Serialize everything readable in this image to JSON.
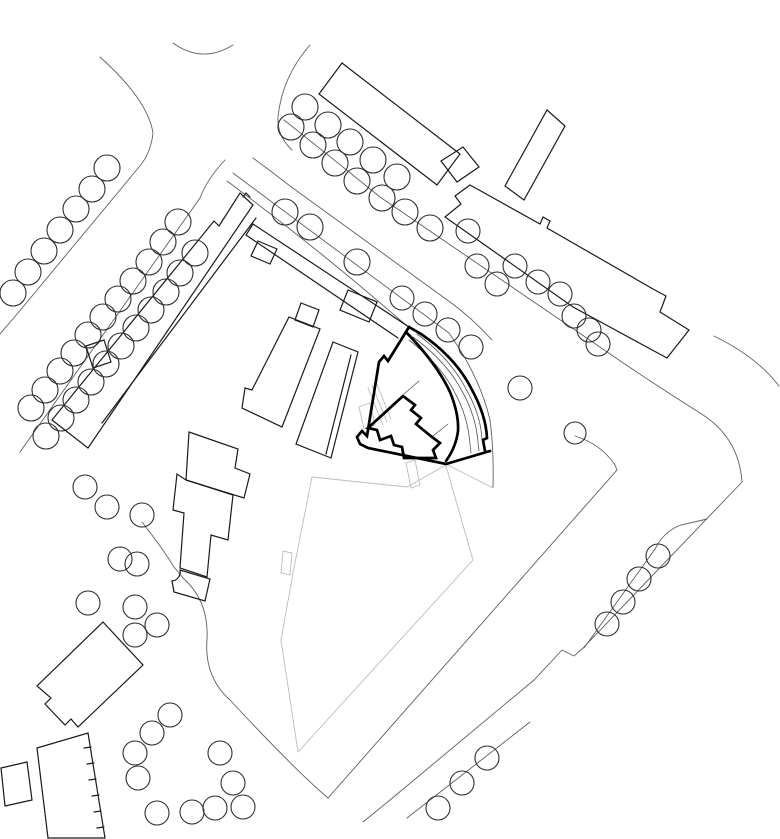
{
  "meta": {
    "type": "architectural-site-plan",
    "description": "black-and-white site plan with highlighted (bold) project building, tree circles, roads and neighbouring buildings",
    "canvas": {
      "width": 780,
      "height": 839
    },
    "colors": {
      "background": "#ffffff",
      "building_line": "#1a1a1a",
      "tree_line": "#2e2e2e",
      "road_line": "#5f5f5f",
      "light_gray_line": "#bdbdbd",
      "bold_highlight": "#000000"
    }
  },
  "styles": {
    "bld": {
      "stroke": "#1a1a1a",
      "width": 1.2
    },
    "tree": {
      "stroke": "#2e2e2e",
      "width": 1.1
    },
    "road": {
      "stroke": "#5f5f5f",
      "width": 0.9
    },
    "gray": {
      "stroke": "#bdbdbd",
      "width": 0.9
    },
    "bold": {
      "stroke": "#000000",
      "width": 2.7
    },
    "thin": {
      "stroke": "#555555",
      "width": 0.8
    }
  },
  "plan": {
    "gray_lines": [
      {
        "name": "plot-boundary-left",
        "d": "M312,477 L293,573 L281,640 L298,752"
      },
      {
        "name": "plot-boundary-right",
        "d": "M298,752 L473,560 L446,466"
      },
      {
        "name": "plot-boundary-top",
        "d": "M446,465 L407,487 L312,477"
      },
      {
        "name": "plot-connector",
        "d": "M446,464 L493,488"
      },
      {
        "name": "boundary-marker-rect",
        "d": "M283,551 L292,553 L290,575 L281,573 Z"
      },
      {
        "name": "entry-path-rect",
        "d": "M406,463 L415,460 L420,485 L411,488 Z"
      },
      {
        "name": "ramp-line-1",
        "d": "M368,388 L383,425"
      },
      {
        "name": "ramp-line-2",
        "d": "M372,385 L387,422"
      },
      {
        "name": "ramp-line-3",
        "d": "M376,382 L391,419"
      },
      {
        "name": "small-gray-rect",
        "d": "M359,407 L370,403 L375,425 L364,429 Z"
      }
    ],
    "roads": [
      {
        "name": "road-west-edge",
        "d": "M100,57 Q148,100 153,133 Q151,153 139,167 L18,313 L0,334"
      },
      {
        "name": "road-top-arc",
        "d": "M173,43 Q202,64 233,45"
      },
      {
        "name": "road-north-corner",
        "d": "M310,45 Q282,77 278,117 Q277,136 292,150"
      },
      {
        "name": "road-se-sw-edge",
        "d": "M253,158 Q272,172 290,186 L450,302 Q472,318 492,340"
      },
      {
        "name": "road-se-ne-edge",
        "d": "M284,120 Q332,158 380,197 L597,345 Q646,379 700,413 Q739,437 742,482"
      },
      {
        "name": "sidewalk-line-1",
        "d": "M233,173 Q340,253 449,333 Q480,377 490,420 Q494,450 493,487"
      },
      {
        "name": "sidewalk-line-2",
        "d": "M227,181 Q320,250 407,326"
      },
      {
        "name": "block-fence-west",
        "d": "M225,160 Q207,179 200,198 L20,452"
      },
      {
        "name": "path-around-houses",
        "d": "M142,522 Q163,549 174,567 Q179,573 183,578"
      },
      {
        "name": "road-south-edge",
        "d": "M575,436 Q601,444 615,465 L617,470 L328,798 Q294,769 230,700 Q204,677 207,639 Q209,601 183,578"
      },
      {
        "name": "road-southeast-edge",
        "d": "M742,482 L583,648 L574,656 L562,650 L534,680 L390,800 L363,822"
      },
      {
        "name": "road-northeast-arc",
        "d": "M714,336 Q757,357 779,386"
      },
      {
        "name": "road-se-corner-line",
        "d": "M407,818 L530,722"
      },
      {
        "name": "tree-enclosure",
        "d": "M584,648 L655,549 Q664,531 681,525 L707,519"
      }
    ],
    "buildings": [
      {
        "name": "long-building",
        "d": "M240,193 L253,205 L88,448 L52,420 L214,221 L219,226 Z"
      },
      {
        "name": "long-building-notch",
        "d": "M243,197 L246,193 L250,197"
      },
      {
        "name": "long-building-annex",
        "d": "M256,218 L102,423"
      },
      {
        "name": "terrace-strip-ne",
        "d": "M253,224 L409,327"
      },
      {
        "name": "terrace-strip-sw",
        "d": "M246,235 L398,338"
      },
      {
        "name": "terrace-strip-end",
        "d": "M253,224 L246,235"
      },
      {
        "name": "strip-bump-1",
        "d": "M258,241 L277,249 L270,264 L251,256 Z"
      },
      {
        "name": "strip-bump-2",
        "d": "M348,290 L377,302 L369,322 L340,310 Z"
      },
      {
        "name": "strip-connector",
        "d": "M301,303 L319,310 L313,327 L295,320 Z"
      },
      {
        "name": "planter",
        "d": "M86,346 L104,340 L111,362 L93,368 Z"
      },
      {
        "name": "center-slab-a",
        "d": "M289,317 L320,329 L282,427 L242,408 L245,388 L252,390 Z"
      },
      {
        "name": "center-slab-b",
        "d": "M333,342 L358,352 L331,458 L296,444 Z"
      },
      {
        "name": "center-slab-b-inner",
        "d": "M351,355 L326,454"
      },
      {
        "name": "ne-slab-1",
        "d": "M342,63 L319,94 L437,185 L460,154 Z"
      },
      {
        "name": "ne-link-square",
        "d": "M441,161 L463,147 L479,167 L457,182 Z"
      },
      {
        "name": "ne-building-2",
        "d": "M470,185 L540,224 L543,217 L550,221 L547,228 L653,289 L666,296 L660,312 L689,330 L667,358 L573,307 L445,217 L461,204 L455,196 Z"
      },
      {
        "name": "ne-building-2-wing",
        "d": "M547,110 L565,126 L524,200 L505,186 Z"
      },
      {
        "name": "house-a",
        "d": "M189,432 L238,449 L235,468 L250,474 L244,498 L186,480 Z"
      },
      {
        "name": "house-b",
        "d": "M186,480 L233,495 L228,540 L211,535 L207,577 L180,568 L184,513 L173,510 L177,474 Z"
      },
      {
        "name": "house-c",
        "d": "M180,570 L210,579 L205,601 L174,592 L172,581 A9,9 0 0 0 180,570 Z"
      },
      {
        "name": "house-d",
        "d": "M103,622 L143,665 L78,727 L71,719 L65,725 L45,704 L51,698 L37,686 Z"
      },
      {
        "name": "garage-building",
        "d": "M37,748 L88,733 L105,838 L48,838 Z"
      },
      {
        "name": "garage-ticks",
        "d": "M91,747 l-7,1 M94,763 l-7,1 M96,779 l-7,1 M99,795 l-7,1 M101,811 l-7,1 M104,827 l-7,1"
      },
      {
        "name": "sw-small-rect",
        "d": "M1,768 L27,762 L32,800 L5,806 Z"
      }
    ],
    "bold_building": {
      "label": "highlighted project building",
      "paths": [
        {
          "name": "site-boundary",
          "d": "M409,327 L388,361 L384,356 L379,362 L367,436 L362,431 L357,437 L360,444 L368,448 L446,464 L490,451"
        },
        {
          "name": "curved-band-outer",
          "d": "M409,327 L421,334 Q455,357 471,388 Q486,415 487,438 L483,440 L485,451"
        },
        {
          "name": "curved-band-inner",
          "d": "M406,332 Q437,364 450,392 Q459,414 458,431 Q456,447 446,461"
        },
        {
          "name": "inner-house",
          "d": "M403,396 L415,405 L411,410 L421,418 L416,424 L432,437 L440,443 L433,450 L436,458 L404,458 L402,447 L394,445 L391,436 L380,440 L377,430 L368,428 Z"
        }
      ],
      "thin_paths": [
        {
          "name": "balcony-curve-1",
          "d": "M413,337 Q446,361 462,391 Q476,416 478,442 L479,451"
        },
        {
          "name": "balcony-curve-2",
          "d": "M417,334 Q450,358 466,389 Q481,415 482,440"
        },
        {
          "name": "balcony-curve-3",
          "d": "M409,340 Q441,365 455,393 Q468,417 470,444 L471,453"
        },
        {
          "name": "link-line-1",
          "d": "M404,394 L419,381"
        },
        {
          "name": "link-line-2",
          "d": "M433,436 L448,424"
        }
      ]
    },
    "trees": {
      "default_radius": 13,
      "groups": [
        {
          "name": "upper-left-row",
          "r": 13,
          "centers": [
            [
              107,
              168
            ],
            [
              92,
              189
            ],
            [
              76,
              209
            ],
            [
              60,
              230
            ],
            [
              44,
              251
            ],
            [
              28,
              272
            ],
            [
              13,
              293
            ]
          ]
        },
        {
          "name": "west-row-1",
          "r": 13,
          "centers": [
            [
              178,
              222
            ],
            [
              163,
              242
            ],
            [
              149,
              262
            ],
            [
              133,
              281
            ],
            [
              118,
              299
            ],
            [
              103,
              317
            ],
            [
              88,
              335
            ],
            [
              74,
              353
            ],
            [
              60,
              371
            ],
            [
              45,
              390
            ],
            [
              31,
              408
            ]
          ]
        },
        {
          "name": "west-row-2",
          "r": 13,
          "centers": [
            [
              195,
              253
            ],
            [
              180,
              273
            ],
            [
              166,
              292
            ],
            [
              151,
              310
            ],
            [
              136,
              328
            ],
            [
              121,
              346
            ],
            [
              106,
              364
            ],
            [
              91,
              382
            ],
            [
              76,
              400
            ],
            [
              61,
              418
            ],
            [
              46,
              436
            ]
          ]
        },
        {
          "name": "west-lower-trio",
          "r": 12,
          "centers": [
            [
              85,
              487
            ],
            [
              107,
              507
            ],
            [
              142,
              515
            ]
          ]
        },
        {
          "name": "northeast-row-1",
          "r": 13,
          "centers": [
            [
              305,
              107
            ],
            [
              328,
              125
            ],
            [
              350,
              142
            ],
            [
              373,
              160
            ],
            [
              397,
              177
            ]
          ]
        },
        {
          "name": "northeast-row-2",
          "r": 13,
          "centers": [
            [
              291,
              127
            ],
            [
              313,
              145
            ],
            [
              335,
              163
            ],
            [
              357,
              181
            ],
            [
              382,
              198
            ],
            [
              405,
              212
            ],
            [
              430,
              228
            ]
          ]
        },
        {
          "name": "northeast-row-3",
          "r": 12,
          "centers": [
            [
              468,
              231
            ],
            [
              477,
              266
            ],
            [
              497,
              284
            ],
            [
              515,
              266
            ],
            [
              538,
              282
            ],
            [
              560,
              294
            ],
            [
              574,
              316
            ],
            [
              589,
              330
            ],
            [
              598,
              344
            ]
          ]
        },
        {
          "name": "corridor-trees",
          "r": 13,
          "centers": [
            [
              285,
              212
            ],
            [
              310,
              227
            ],
            [
              357,
              262
            ]
          ]
        },
        {
          "name": "project-row",
          "r": 12,
          "centers": [
            [
              402,
              298
            ],
            [
              425,
              314
            ],
            [
              448,
              330
            ],
            [
              471,
              347
            ]
          ]
        },
        {
          "name": "east-single-1",
          "r": 12,
          "centers": [
            [
              520,
              388
            ]
          ]
        },
        {
          "name": "east-single-2",
          "r": 11,
          "centers": [
            [
              575,
              433
            ]
          ]
        },
        {
          "name": "south-cluster",
          "r": 12,
          "centers": [
            [
              120,
              559
            ],
            [
              137,
              564
            ],
            [
              88,
              603
            ],
            [
              135,
              607
            ],
            [
              157,
              625
            ],
            [
              135,
              635
            ],
            [
              170,
              715
            ],
            [
              152,
              733
            ],
            [
              135,
              753
            ],
            [
              138,
              778
            ],
            [
              220,
              753
            ],
            [
              233,
              783
            ],
            [
              243,
              807
            ],
            [
              215,
              808
            ],
            [
              192,
              812
            ],
            [
              157,
              813
            ]
          ]
        },
        {
          "name": "enclosure-row",
          "r": 12,
          "centers": [
            [
              607,
              624
            ],
            [
              623,
              602
            ],
            [
              639,
              579
            ],
            [
              658,
              556
            ]
          ]
        },
        {
          "name": "southeast-trio",
          "r": 12,
          "centers": [
            [
              438,
              808
            ],
            [
              462,
              783
            ],
            [
              487,
              758
            ]
          ]
        }
      ]
    }
  }
}
